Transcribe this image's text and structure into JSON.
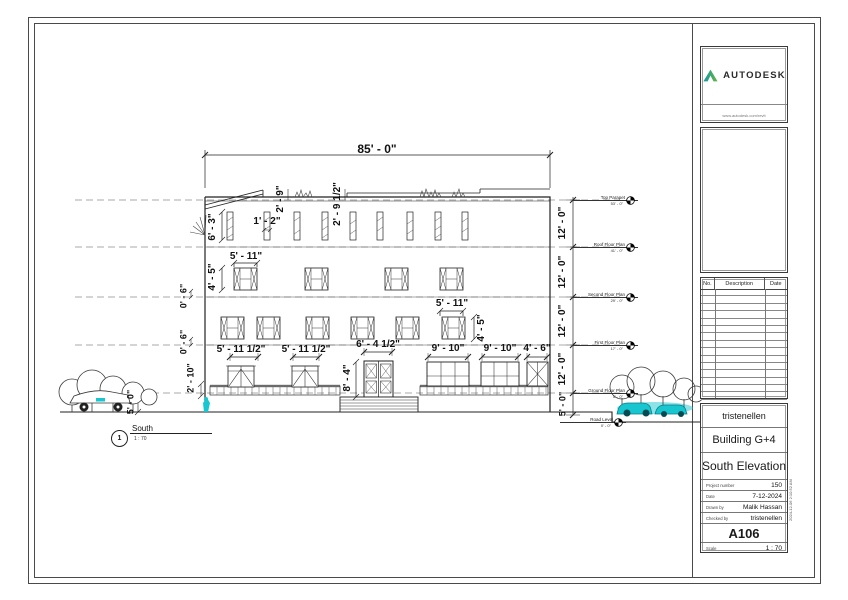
{
  "page": {
    "drawing": {
      "view_title": {
        "number": "1",
        "name": "South",
        "scale": "1 : 70"
      },
      "dims": {
        "overall_width": "85' - 0\"",
        "parapet_left": "2' - 9\"",
        "parapet_right": "2' - 9 1/2\"",
        "slit_window_height": "6' - 3\"",
        "slit_window_width": "1' - 2\"",
        "second_window_width": "5' - 11\"",
        "second_window_height": "4' - 5\"",
        "first_window_width": "5' - 11\"",
        "first_window_height": "4' - 5\"",
        "sill_upper": "0' - 6\"",
        "sill_lower": "0' - 6\"",
        "porch_height": "2' - 10\"",
        "plinth_height": "5' - 0\"",
        "left_door_1": "5' - 11 1/2\"",
        "left_door_2": "5' - 11 1/2\"",
        "main_door_width": "6' - 4 1/2\"",
        "main_door_height": "8' - 4\"",
        "storefront_1": "9' - 10\"",
        "storefront_2": "9' - 10\"",
        "storefront_3": "4' - 6\"",
        "right_chain": [
          "12' - 0\"",
          "12' - 0\"",
          "12' - 0\"",
          "12' - 0\"",
          "5' - 0\""
        ]
      },
      "levels": [
        {
          "name": "Top Parapet",
          "elevation": "53' - 0\""
        },
        {
          "name": "Roof Floor Plan",
          "elevation": "41' - 0\""
        },
        {
          "name": "Second Floor Plan",
          "elevation": "29' - 0\""
        },
        {
          "name": "First Floor Plan",
          "elevation": "17' - 0\""
        },
        {
          "name": "Ground Floor Plan",
          "elevation": "5' - 0\""
        },
        {
          "name": "Road Level",
          "elevation": "0' - 0\""
        }
      ]
    },
    "titleblock": {
      "logo": {
        "brand": "AUTODESK",
        "url": "www.autodesk.com/revit"
      },
      "revisions": {
        "headers": [
          "No.",
          "Description",
          "Date"
        ],
        "rows": 17
      },
      "project": {
        "client": "tristenellen",
        "name": "Building G+4",
        "sheet_title": "South Elevation"
      },
      "fields": [
        {
          "label": "Project number",
          "value": "150"
        },
        {
          "label": "Date",
          "value": "7-12-2024"
        },
        {
          "label": "Drawn by",
          "value": "Malik Hassan"
        },
        {
          "label": "Checked by",
          "value": "tristenellen"
        }
      ],
      "sheet_number": "A106",
      "scale_label": "Scale",
      "scale_value": "1 : 70",
      "print_stamp": "2024-12-06 2:10:52 AM"
    },
    "colors": {
      "accent_teal": "#17c6cf",
      "logo_teal": "#0e9aa8",
      "logo_green": "#6cb33f"
    }
  }
}
